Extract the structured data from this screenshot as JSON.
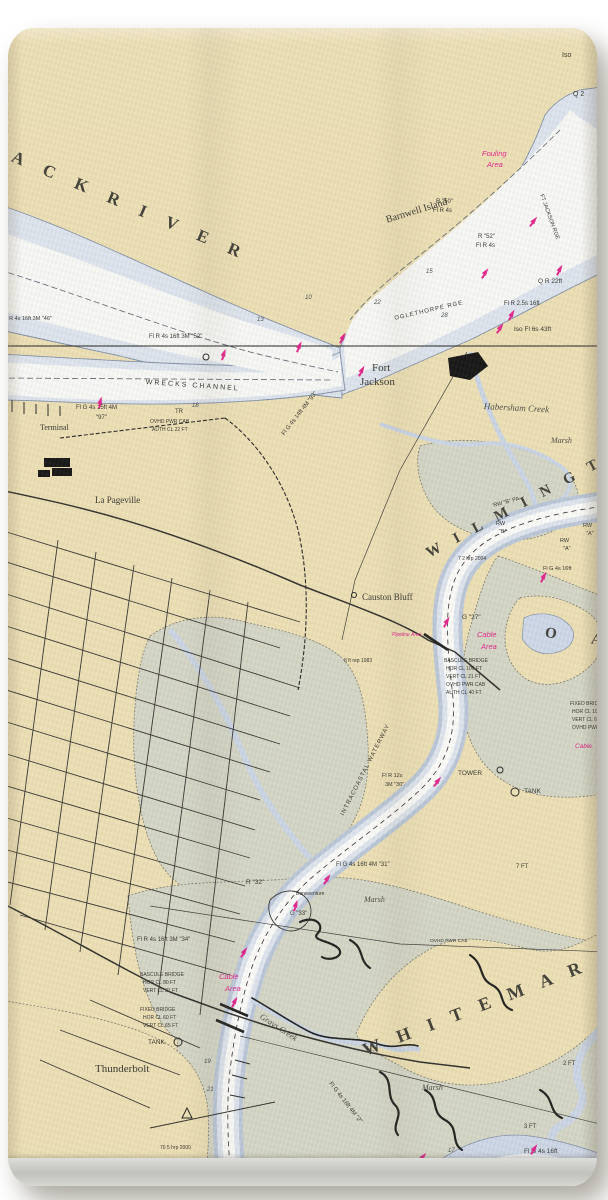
{
  "product": {
    "type_label": "nautical-chart beach towel photo",
    "colors": {
      "land": "#ecdfb4",
      "marsh": "#d3d5c5",
      "water_edge": "#c3cede",
      "water": "#dde4ee",
      "channel_white": "#f7f8f6",
      "magenta": "#e0218a",
      "ink": "#2e2d28",
      "hem": "#c6c6c2",
      "background": "#ffffff"
    }
  },
  "map": {
    "region": "Savannah River / Wilmington River / Thunderbolt",
    "labels": [
      {
        "id": "back-river",
        "text": "A C K    R I V E R",
        "x": 16,
        "y": 148,
        "rot": 23,
        "size": 17,
        "ls": 9,
        "cls": "big"
      },
      {
        "id": "wilmington-river",
        "text": "W I L M I N G T O N",
        "x": 424,
        "y": 548,
        "rot": -28,
        "size": 15,
        "ls": 6,
        "cls": "big"
      },
      {
        "id": "oatland",
        "text": "O A",
        "x": 546,
        "y": 626,
        "rot": 8,
        "size": 15,
        "ls": 16,
        "cls": "big"
      },
      {
        "id": "whitemarsh",
        "text": "W H I T E M A R",
        "x": 360,
        "y": 1042,
        "rot": -21,
        "size": 18,
        "ls": 7,
        "cls": "big"
      },
      {
        "id": "intracoastal",
        "text": "INTRACOASTAL WATERWAY",
        "x": 340,
        "y": 814,
        "rot": -63,
        "size": 6,
        "ls": 1,
        "cls": "nav"
      },
      {
        "id": "barnwell-island",
        "text": "Barnwell Island",
        "x": 385,
        "y": 216,
        "rot": -17,
        "size": 10,
        "cls": "place"
      },
      {
        "id": "fort-jackson-1",
        "text": "Fort",
        "x": 372,
        "y": 363,
        "size": 11,
        "cls": "place"
      },
      {
        "id": "fort-jackson-2",
        "text": "Jackson",
        "x": 360,
        "y": 377,
        "size": 11,
        "cls": "place"
      },
      {
        "id": "habersham-creek",
        "text": "Habersham Creek",
        "x": 484,
        "y": 402,
        "rot": 3,
        "size": 9,
        "cls": "water"
      },
      {
        "id": "marsh-1",
        "text": "Marsh",
        "x": 551,
        "y": 437,
        "size": 8,
        "cls": "water"
      },
      {
        "id": "causton-bluff",
        "text": "Causton Bluff",
        "x": 362,
        "y": 593,
        "size": 9,
        "cls": "place"
      },
      {
        "id": "la-pageville",
        "text": "La Pageville",
        "x": 95,
        "y": 496,
        "size": 9,
        "cls": "place"
      },
      {
        "id": "terminal",
        "text": "Terminal",
        "x": 40,
        "y": 424,
        "size": 8,
        "cls": "place"
      },
      {
        "id": "thunderbolt",
        "text": "Thunderbolt",
        "x": 95,
        "y": 1064,
        "size": 11,
        "cls": "place"
      },
      {
        "id": "grays-creek",
        "text": "Grays Creek",
        "x": 263,
        "y": 1012,
        "rot": 33,
        "size": 8.5,
        "cls": "water"
      },
      {
        "id": "wrecks-channel",
        "text": "WRECKS CHANNEL",
        "x": 146,
        "y": 379,
        "rot": 4,
        "size": 7,
        "ls": 2,
        "cls": "nav"
      },
      {
        "id": "oglethorpe-rge",
        "text": "OGLETHORPE RGE",
        "x": 394,
        "y": 316,
        "rot": -13,
        "size": 6,
        "ls": 1,
        "cls": "nav"
      },
      {
        "id": "ft-jackson-rge",
        "text": "FT JACKSON RGE",
        "x": 543,
        "y": 194,
        "rot": 70,
        "size": 5.5,
        "cls": "nav"
      },
      {
        "id": "marsh-2",
        "text": "Marsh",
        "x": 364,
        "y": 896,
        "size": 8,
        "cls": "water"
      },
      {
        "id": "marsh-3",
        "text": "Marsh",
        "x": 422,
        "y": 1084,
        "size": 8,
        "cls": "water"
      },
      {
        "id": "bonaventure",
        "text": "Bonaventure",
        "x": 296,
        "y": 892,
        "size": 5,
        "cls": "nav"
      },
      {
        "id": "fouling-1",
        "text": "Fouling",
        "x": 482,
        "y": 150,
        "size": 7.5,
        "cls": "pink"
      },
      {
        "id": "fouling-2",
        "text": "Area",
        "x": 487,
        "y": 161,
        "size": 7.5,
        "cls": "pink"
      },
      {
        "id": "cable-area-1a",
        "text": "Cable",
        "x": 477,
        "y": 631,
        "size": 7.5,
        "cls": "pink"
      },
      {
        "id": "cable-area-1b",
        "text": "Area",
        "x": 481,
        "y": 643,
        "size": 7.5,
        "cls": "pink"
      },
      {
        "id": "pipeline-area",
        "text": "Pipeline Area",
        "x": 392,
        "y": 633,
        "size": 5,
        "cls": "pink"
      },
      {
        "id": "cable-area-2a",
        "text": "Cable",
        "x": 219,
        "y": 973,
        "size": 7.5,
        "cls": "pink"
      },
      {
        "id": "cable-area-2b",
        "text": "Area",
        "x": 225,
        "y": 985,
        "size": 7.5,
        "cls": "pink"
      },
      {
        "id": "cable-area-3",
        "text": "Cable",
        "x": 575,
        "y": 744,
        "size": 6.5,
        "cls": "pink"
      },
      {
        "id": "iso",
        "text": "Iso",
        "x": 562,
        "y": 52,
        "size": 7,
        "cls": "nav"
      },
      {
        "id": "q2",
        "text": "Q 2",
        "x": 573,
        "y": 91,
        "size": 7,
        "cls": "nav"
      },
      {
        "id": "r50a",
        "text": "R \"50\"",
        "x": 436,
        "y": 199,
        "size": 6,
        "cls": "nav"
      },
      {
        "id": "r50b",
        "text": "Fl R 4s",
        "x": 433,
        "y": 208,
        "size": 6,
        "cls": "nav"
      },
      {
        "id": "r52a",
        "text": "R \"52\"",
        "x": 478,
        "y": 234,
        "size": 6,
        "cls": "nav"
      },
      {
        "id": "r52b",
        "text": "Fl R 4s",
        "x": 476,
        "y": 243,
        "size": 6,
        "cls": "nav"
      },
      {
        "id": "qr22",
        "text": "Q R 22ft",
        "x": 538,
        "y": 279,
        "size": 6.5,
        "cls": "nav"
      },
      {
        "id": "flr25",
        "text": "Fl R 2.5s 16ft",
        "x": 504,
        "y": 301,
        "size": 6,
        "cls": "nav"
      },
      {
        "id": "iso43",
        "text": "Iso Fl 6s 43ft",
        "x": 514,
        "y": 327,
        "size": 6.5,
        "cls": "nav"
      },
      {
        "id": "fl52",
        "text": "Fl R 4s 16ft 3M \"52\"",
        "x": 149,
        "y": 334,
        "size": 6,
        "cls": "nav"
      },
      {
        "id": "fl46",
        "text": "Fl R 4s 16ft 3M \"46\"",
        "x": 3,
        "y": 317,
        "size": 5.5,
        "cls": "nav"
      },
      {
        "id": "flg15",
        "text": "Fl G 4s 15ft 4M",
        "x": 76,
        "y": 405,
        "size": 6,
        "cls": "nav"
      },
      {
        "id": "n97",
        "text": "\"97\"",
        "x": 96,
        "y": 415,
        "size": 6,
        "cls": "nav"
      },
      {
        "id": "ovhd1a",
        "text": "OVHD PWR CAB",
        "x": 150,
        "y": 420,
        "size": 5,
        "cls": "nav"
      },
      {
        "id": "ovhd1b",
        "text": "AUTH CL 22 FT",
        "x": 152,
        "y": 428,
        "size": 5,
        "cls": "nav"
      },
      {
        "id": "tr",
        "text": "TR",
        "x": 175,
        "y": 409,
        "size": 6,
        "cls": "nav"
      },
      {
        "id": "flg93",
        "text": "Fl G 4s 14ft 4M \"93\"",
        "x": 281,
        "y": 433,
        "rot": -52,
        "size": 6,
        "cls": "nav"
      },
      {
        "id": "flg31",
        "text": "Fl G 4s 16ft 4M \"31\"",
        "x": 336,
        "y": 862,
        "size": 6,
        "cls": "nav"
      },
      {
        "id": "r32",
        "text": "R \"32\"",
        "x": 246,
        "y": 880,
        "size": 6.5,
        "cls": "nav"
      },
      {
        "id": "g33",
        "text": "G \"33\"",
        "x": 290,
        "y": 911,
        "size": 6,
        "cls": "nav"
      },
      {
        "id": "g27",
        "text": "G \"27\"",
        "x": 462,
        "y": 615,
        "size": 6.5,
        "cls": "nav"
      },
      {
        "id": "flr12a",
        "text": "Fl R 12s",
        "x": 382,
        "y": 774,
        "size": 5.5,
        "cls": "nav"
      },
      {
        "id": "flr12b",
        "text": "3M \"30\"",
        "x": 385,
        "y": 783,
        "size": 5.5,
        "cls": "nav"
      },
      {
        "id": "fl34",
        "text": "Fl R 4s 16ft 3M \"34\"",
        "x": 137,
        "y": 937,
        "size": 6,
        "cls": "nav"
      },
      {
        "id": "bb1a",
        "text": "BASCULE BRIDGE",
        "x": 140,
        "y": 973,
        "size": 5,
        "cls": "nav"
      },
      {
        "id": "bb1b",
        "text": "HOR CL 80 FT",
        "x": 143,
        "y": 981,
        "size": 5,
        "cls": "nav"
      },
      {
        "id": "bb1c",
        "text": "VERT CL 21 FT",
        "x": 143,
        "y": 989,
        "size": 5,
        "cls": "nav"
      },
      {
        "id": "fb1a",
        "text": "FIXED BRIDGE",
        "x": 140,
        "y": 1008,
        "size": 5,
        "cls": "nav"
      },
      {
        "id": "fb1b",
        "text": "HOR CL 60 FT",
        "x": 143,
        "y": 1016,
        "size": 5,
        "cls": "nav"
      },
      {
        "id": "fb1c",
        "text": "VERT CL 65 FT",
        "x": 143,
        "y": 1024,
        "size": 5,
        "cls": "nav"
      },
      {
        "id": "bb2a",
        "text": "BASCULE BRIDGE",
        "x": 444,
        "y": 659,
        "size": 5,
        "cls": "nav"
      },
      {
        "id": "bb2b",
        "text": "HOR CL 100 FT",
        "x": 446,
        "y": 667,
        "size": 5,
        "cls": "nav"
      },
      {
        "id": "bb2c",
        "text": "VERT CL 21 FT",
        "x": 446,
        "y": 675,
        "size": 5,
        "cls": "nav"
      },
      {
        "id": "bb2d",
        "text": "OVHD PWR CAB",
        "x": 446,
        "y": 683,
        "size": 5,
        "cls": "nav"
      },
      {
        "id": "bb2e",
        "text": "AUTH CL 40 FT",
        "x": 446,
        "y": 691,
        "size": 5,
        "cls": "nav"
      },
      {
        "id": "fb2a",
        "text": "FIXED BRID",
        "x": 570,
        "y": 702,
        "size": 5,
        "cls": "nav"
      },
      {
        "id": "fb2b",
        "text": "HOR CL 10",
        "x": 572,
        "y": 710,
        "size": 5,
        "cls": "nav"
      },
      {
        "id": "fb2c",
        "text": "VERT CL 6",
        "x": 572,
        "y": 718,
        "size": 5,
        "cls": "nav"
      },
      {
        "id": "fb2d",
        "text": "OVHD PWR",
        "x": 572,
        "y": 726,
        "size": 5,
        "cls": "nav"
      },
      {
        "id": "tower",
        "text": "TOWER",
        "x": 458,
        "y": 771,
        "size": 6.5,
        "cls": "nav"
      },
      {
        "id": "tank-1",
        "text": "TANK",
        "x": 524,
        "y": 789,
        "size": 6.5,
        "cls": "nav"
      },
      {
        "id": "tank-2",
        "text": "TANK",
        "x": 148,
        "y": 1040,
        "size": 6.5,
        "cls": "nav"
      },
      {
        "id": "ft7",
        "text": "7 FT",
        "x": 516,
        "y": 864,
        "size": 6,
        "cls": "nav"
      },
      {
        "id": "ft2",
        "text": "2 FT",
        "x": 563,
        "y": 1061,
        "size": 6,
        "cls": "nav"
      },
      {
        "id": "ft3",
        "text": "3 FT",
        "x": 524,
        "y": 1124,
        "size": 6,
        "cls": "nav"
      },
      {
        "id": "rep83",
        "text": "8 ft rep 1983",
        "x": 344,
        "y": 659,
        "size": 5,
        "cls": "nav"
      },
      {
        "id": "hrp04",
        "text": "7 2 hrp 2004",
        "x": 458,
        "y": 557,
        "size": 5,
        "cls": "nav"
      },
      {
        "id": "hrp00",
        "text": "70 5 hrp 2000",
        "x": 160,
        "y": 1146,
        "size": 5,
        "cls": "nav"
      },
      {
        "id": "rwb-pa",
        "text": "RW \"B\" PA",
        "x": 493,
        "y": 504,
        "rot": -15,
        "size": 5.5,
        "cls": "nav"
      },
      {
        "id": "rwb1",
        "text": "RW",
        "x": 496,
        "y": 522,
        "size": 5.5,
        "cls": "nav"
      },
      {
        "id": "rwb2",
        "text": "\"B\"",
        "x": 499,
        "y": 530,
        "size": 5.5,
        "cls": "nav"
      },
      {
        "id": "rwa1",
        "text": "RW",
        "x": 560,
        "y": 539,
        "size": 5.5,
        "cls": "nav"
      },
      {
        "id": "rwa2",
        "text": "\"A\"",
        "x": 563,
        "y": 547,
        "size": 5.5,
        "cls": "nav"
      },
      {
        "id": "rwa3",
        "text": "RW",
        "x": 583,
        "y": 524,
        "size": 5.5,
        "cls": "nav"
      },
      {
        "id": "rwa4",
        "text": "\"A\"",
        "x": 586,
        "y": 532,
        "size": 5.5,
        "cls": "nav"
      },
      {
        "id": "flg16",
        "text": "Fl G 4s 16ft",
        "x": 543,
        "y": 567,
        "size": 5.5,
        "cls": "nav"
      },
      {
        "id": "flg2",
        "text": "Fl G 4s 16ft 4M \"2\"",
        "x": 332,
        "y": 1081,
        "rot": 52,
        "size": 6,
        "cls": "nav"
      },
      {
        "id": "flg16b",
        "text": "Fl G 4s 16ft",
        "x": 524,
        "y": 1149,
        "size": 6.5,
        "cls": "nav"
      },
      {
        "id": "ovhd3",
        "text": "OVHD PWR CAB",
        "x": 430,
        "y": 940,
        "size": 4.8,
        "cls": "nav"
      },
      {
        "id": "d15",
        "text": "15",
        "x": 426,
        "y": 269,
        "size": 6,
        "cls": "depth"
      },
      {
        "id": "d22",
        "text": "22",
        "x": 374,
        "y": 300,
        "size": 6,
        "cls": "depth"
      },
      {
        "id": "d28",
        "text": "28",
        "x": 441,
        "y": 313,
        "size": 6,
        "cls": "depth"
      },
      {
        "id": "d18",
        "text": "18",
        "x": 192,
        "y": 403,
        "size": 6,
        "cls": "depth"
      },
      {
        "id": "d13",
        "text": "13",
        "x": 257,
        "y": 317,
        "size": 6,
        "cls": "depth"
      },
      {
        "id": "d10",
        "text": "10",
        "x": 305,
        "y": 295,
        "size": 6,
        "cls": "depth"
      },
      {
        "id": "d17",
        "text": "17",
        "x": 448,
        "y": 1148,
        "size": 6,
        "cls": "depth"
      },
      {
        "id": "d19",
        "text": "19",
        "x": 204,
        "y": 1059,
        "size": 6,
        "cls": "depth"
      },
      {
        "id": "d21",
        "text": "21",
        "x": 207,
        "y": 1087,
        "size": 6,
        "cls": "depth"
      }
    ],
    "buoys": [
      [
        526,
        214,
        40
      ],
      [
        478,
        266,
        35
      ],
      [
        553,
        263,
        30
      ],
      [
        505,
        308,
        30
      ],
      [
        493,
        321,
        35
      ],
      [
        218,
        348,
        20
      ],
      [
        293,
        340,
        25
      ],
      [
        336,
        331,
        30
      ],
      [
        355,
        364,
        30
      ],
      [
        95,
        396,
        15
      ],
      [
        430,
        774,
        40
      ],
      [
        237,
        945,
        35
      ],
      [
        415,
        1150,
        40
      ],
      [
        527,
        1142,
        35
      ],
      [
        320,
        872,
        35
      ],
      [
        537,
        570,
        30
      ],
      [
        440,
        615,
        30
      ],
      [
        228,
        995,
        30
      ],
      [
        290,
        899,
        20
      ]
    ]
  }
}
